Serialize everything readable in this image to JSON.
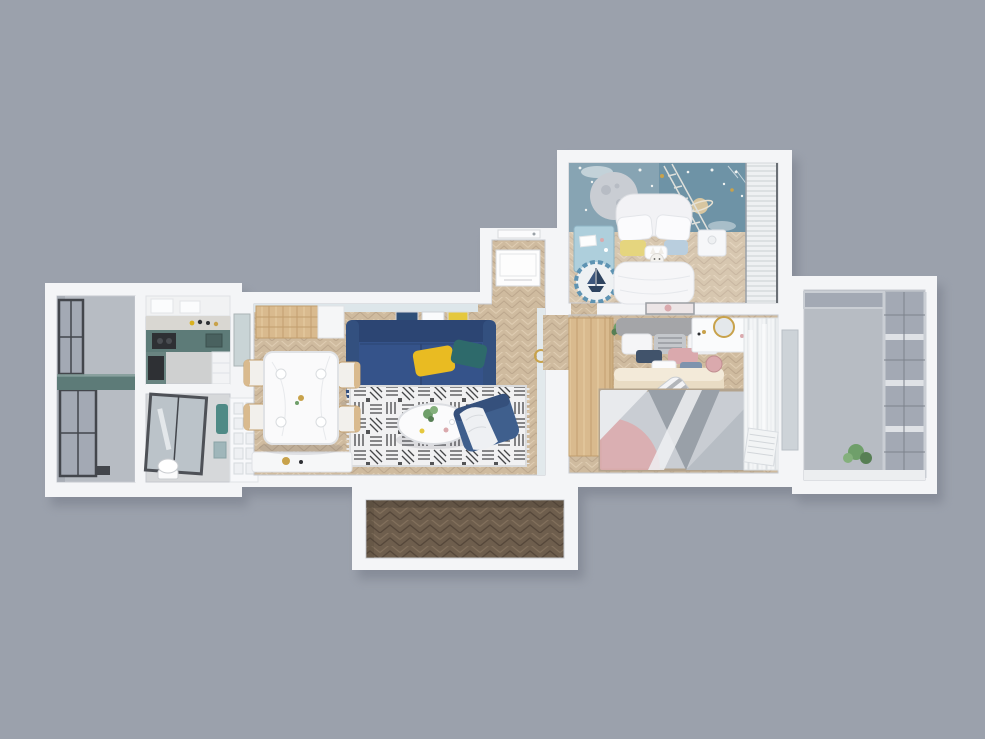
{
  "scene": {
    "description": "Top-down 3D render of an apartment floor plan on a plain gray background",
    "rooms": [
      "left-balcony",
      "kitchen",
      "bathroom",
      "hall-closet",
      "dining-area",
      "living-room",
      "entry-hall",
      "kids-bedroom",
      "master-bedroom",
      "right-balcony",
      "lower-balcony"
    ],
    "notable_items": [
      "navy-sofa",
      "yellow-pillow",
      "teal-pillow",
      "bw-pattern-rug",
      "round-coffee-table",
      "blue-armchair",
      "dining-table-with-four-chairs",
      "wood-sideboard",
      "kids-bed",
      "space-moon-wall-mural",
      "kids-desk",
      "toy-ship-rug",
      "master-bed",
      "striped-blanket",
      "wood-wardrobe",
      "vanity-with-gold-mirror",
      "geometric-gray-pink-rug",
      "sheer-curtains",
      "teal-kitchen-counter",
      "glass-shower",
      "herringbone-wood-floors",
      "balcony-windows"
    ]
  },
  "palette": {
    "bg": "#9ba1ac",
    "wall": "#f4f5f7",
    "floor_light": "#cfbb9f",
    "floor_dark": "#6e5e4d",
    "balcony_floor": "#b7bcc3",
    "mural": "#6e93a6",
    "moon": "#c9cdd3",
    "sofa": "#35538a",
    "sofa_dark": "#2c4573",
    "pillow_yellow": "#e9bb22",
    "pillow_teal": "#2e6a6b",
    "armchair": "#3f5f8d",
    "wood": "#d9ba8e",
    "wood_dark": "#c19e6d",
    "kids_blue": "#aecfdc",
    "kids_ring": "#5e93b2",
    "bed_white": "#f6f6f8",
    "duvet_cream": "#e9dcc4",
    "headboard": "#a4a5a8",
    "pink": "#daa9ad",
    "gold": "#c8a24b",
    "counter_teal": "#5d7b78",
    "appliance": "#2e3034",
    "glass": "#a3a9b4",
    "frame_dark": "#43464c",
    "blinds": "#eef0f2",
    "curtain": "#f3f5f6",
    "plant": "#6f9f6a",
    "rug_base": "#c9cdd3",
    "rug_gray": "#99a0a8",
    "rug_gray2": "#b7bdc4",
    "rug_edge": "#b3a38d",
    "art_navy": "#2e4f78",
    "art_yellow": "#e5c83e",
    "bath_glass": "#b9c2c8",
    "towel_teal": "#4f8a86"
  }
}
